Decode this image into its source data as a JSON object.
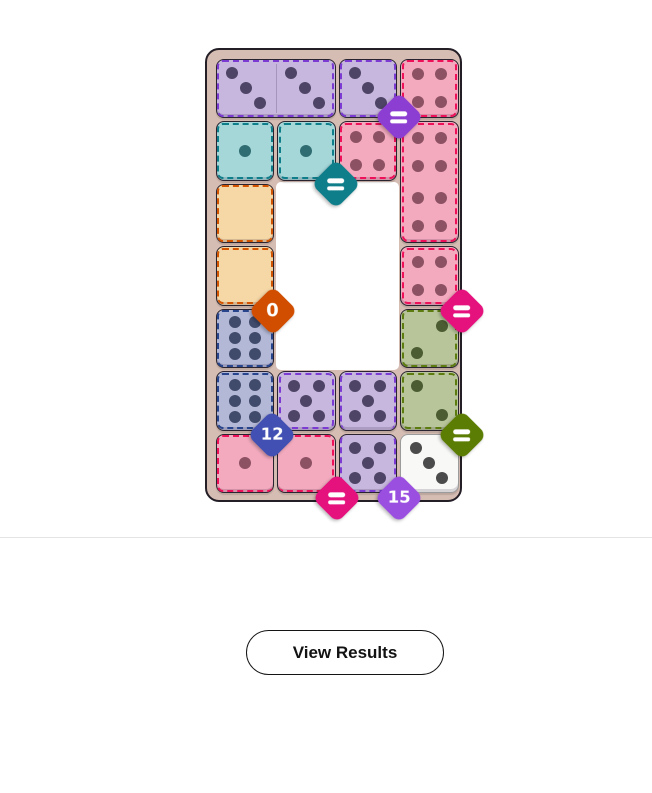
{
  "title": "Domino puzzle board (completed)",
  "board": {
    "x": 205,
    "y": 48,
    "width": 257,
    "height": 454,
    "frame_color": "#d6bdb3",
    "frame_border_color": "#241e26",
    "grid": {
      "x0": 7,
      "y0": 7,
      "cell_w": 61.5,
      "cell_h": 62.5,
      "cols": 4,
      "rows": 7
    },
    "hole": {
      "col": 1,
      "row": 2,
      "cols": 2,
      "rows": 3,
      "color": "#ffffff"
    },
    "regions": {
      "purple": {
        "bg": "#c7b7de",
        "dash": "#7b3ad2",
        "pip": "#4e4566"
      },
      "lavender": {
        "bg": "#c7b7de",
        "dash": "#7b3ad2",
        "pip": "#4e4566"
      },
      "red": {
        "bg": "#f3aabe",
        "dash": "#ee1059",
        "pip": "#8d5164"
      },
      "redb": {
        "bg": "#f3aabe",
        "dash": "#ee1059",
        "pip": "#8d5164"
      },
      "teal": {
        "bg": "#a5d7d9",
        "dash": "#0f7e8b",
        "pip": "#2f6d72"
      },
      "tan": {
        "bg": "#f6d8a7",
        "dash": "#d35400",
        "pip": "#7a5a20"
      },
      "blue": {
        "bg": "#b3b8d6",
        "dash": "#27448d",
        "pip": "#404a6b"
      },
      "green": {
        "bg": "#b8c59a",
        "dash": "#5c7c10",
        "pip": "#4c5c32"
      },
      "plain": {
        "bg": "#f8f8f6",
        "dash": null,
        "pip": "#4b4b4b",
        "border": "#9b9b9b"
      }
    },
    "pip_patterns": {
      "p0": [],
      "p1": [
        [
          50,
          50
        ]
      ],
      "p2dr": [
        [
          28,
          25
        ],
        [
          72,
          75
        ]
      ],
      "p2ur": [
        [
          72,
          29
        ],
        [
          28,
          75
        ]
      ],
      "p3": [
        [
          27,
          24
        ],
        [
          50,
          50
        ],
        [
          73,
          76
        ]
      ],
      "p4": [
        [
          30,
          26
        ],
        [
          70,
          26
        ],
        [
          30,
          74
        ],
        [
          70,
          74
        ]
      ],
      "p5": [
        [
          28,
          24
        ],
        [
          72,
          24
        ],
        [
          50,
          50
        ],
        [
          28,
          76
        ],
        [
          72,
          76
        ]
      ],
      "p6": [
        [
          32,
          22
        ],
        [
          68,
          22
        ],
        [
          32,
          50
        ],
        [
          68,
          50
        ],
        [
          32,
          78
        ],
        [
          68,
          78
        ]
      ]
    },
    "tiles": [
      {
        "name": "domino-3-3",
        "col": 0,
        "row": 0,
        "cols": 2,
        "rows": 1,
        "region": "purple",
        "faces": [
          "p3",
          "p3"
        ],
        "values": [
          3,
          3
        ],
        "seam": true
      },
      {
        "name": "half-3",
        "col": 2,
        "row": 0,
        "region": "purple",
        "faces": [
          "p3"
        ],
        "values": [
          3
        ]
      },
      {
        "name": "half-4",
        "col": 3,
        "row": 0,
        "region": "red",
        "faces": [
          "p4"
        ],
        "values": [
          4
        ]
      },
      {
        "name": "half-1",
        "col": 0,
        "row": 1,
        "region": "teal",
        "faces": [
          "p1"
        ],
        "values": [
          1
        ]
      },
      {
        "name": "half-1",
        "col": 1,
        "row": 1,
        "region": "teal",
        "faces": [
          "p1"
        ],
        "values": [
          1
        ]
      },
      {
        "name": "half-4",
        "col": 2,
        "row": 1,
        "region": "red",
        "faces": [
          "p4"
        ],
        "values": [
          4
        ]
      },
      {
        "name": "domino-4-4",
        "col": 3,
        "row": 1,
        "cols": 1,
        "rows": 2,
        "region": "red",
        "faces": [
          "p4",
          "p4"
        ],
        "values": [
          4,
          4
        ]
      },
      {
        "name": "half-0",
        "col": 0,
        "row": 2,
        "region": "tan",
        "faces": [
          "p0"
        ],
        "values": [
          0
        ]
      },
      {
        "name": "half-0",
        "col": 0,
        "row": 3,
        "region": "tan",
        "faces": [
          "p0"
        ],
        "values": [
          0
        ]
      },
      {
        "name": "half-4",
        "col": 3,
        "row": 3,
        "region": "red",
        "faces": [
          "p4"
        ],
        "values": [
          4
        ]
      },
      {
        "name": "half-6",
        "col": 0,
        "row": 4,
        "region": "blue",
        "faces": [
          "p6"
        ],
        "values": [
          6
        ]
      },
      {
        "name": "half-2",
        "col": 3,
        "row": 4,
        "region": "green",
        "faces": [
          "p2ur"
        ],
        "values": [
          2
        ]
      },
      {
        "name": "half-6",
        "col": 0,
        "row": 5,
        "region": "blue",
        "faces": [
          "p6"
        ],
        "values": [
          6
        ]
      },
      {
        "name": "half-5",
        "col": 1,
        "row": 5,
        "region": "lavender",
        "faces": [
          "p5"
        ],
        "values": [
          5
        ]
      },
      {
        "name": "half-5",
        "col": 2,
        "row": 5,
        "region": "lavender",
        "faces": [
          "p5"
        ],
        "values": [
          5
        ],
        "no_dash": [
          "bottom"
        ]
      },
      {
        "name": "half-2",
        "col": 3,
        "row": 5,
        "region": "green",
        "faces": [
          "p2dr"
        ],
        "values": [
          2
        ]
      },
      {
        "name": "half-1",
        "col": 0,
        "row": 6,
        "region": "redb",
        "faces": [
          "p1"
        ],
        "values": [
          1
        ],
        "no_dash": [
          "right"
        ]
      },
      {
        "name": "half-1",
        "col": 1,
        "row": 6,
        "region": "redb",
        "faces": [
          "p1"
        ],
        "values": [
          1
        ],
        "no_dash": [
          "left"
        ]
      },
      {
        "name": "half-5",
        "col": 2,
        "row": 6,
        "region": "lavender",
        "faces": [
          "p5"
        ],
        "values": [
          5
        ],
        "no_dash": [
          "top"
        ]
      },
      {
        "name": "half-3",
        "col": 3,
        "row": 6,
        "region": "plain",
        "faces": [
          "p3"
        ],
        "values": [
          3
        ]
      }
    ],
    "badges": [
      {
        "name": "constraint-badge-purple-equals",
        "col": 3,
        "row": 1,
        "dx": 0,
        "dy": -3,
        "color": "#8d3ed2",
        "kind": "equals",
        "label": "="
      },
      {
        "name": "constraint-badge-teal-equals",
        "col": 2,
        "row": 2,
        "dx": -1,
        "dy": 2,
        "color": "#0f7e8b",
        "kind": "equals",
        "label": "="
      },
      {
        "name": "constraint-badge-sum-0",
        "col": 1,
        "row": 4,
        "dx": -3,
        "dy": 4,
        "color": "#d14e00",
        "kind": "number",
        "label": "0"
      },
      {
        "name": "constraint-badge-magenta-equals-right",
        "col": 4,
        "row": 4,
        "dx": 2,
        "dy": 4,
        "color": "#e5117d",
        "kind": "equals",
        "label": "="
      },
      {
        "name": "constraint-badge-sum-12",
        "col": 1,
        "row": 6,
        "dx": -4,
        "dy": 3,
        "color": "#4150b2",
        "kind": "number",
        "label": "12"
      },
      {
        "name": "constraint-badge-green-equals",
        "col": 4,
        "row": 6,
        "dx": 2,
        "dy": 3,
        "color": "#5c7d04",
        "kind": "equals",
        "label": "="
      },
      {
        "name": "constraint-badge-magenta-equals-bottom",
        "col": 2,
        "row": 7,
        "dx": 0,
        "dy": 3,
        "color": "#e5117d",
        "kind": "equals",
        "label": "="
      },
      {
        "name": "constraint-badge-sum-15",
        "col": 3,
        "row": 7,
        "dx": 0,
        "dy": 3,
        "color": "#9b4fe0",
        "kind": "number",
        "label": "15"
      }
    ]
  },
  "divider": {
    "y": 537,
    "color": "#e4e4e4"
  },
  "button": {
    "label": "View Results",
    "x": 246,
    "y": 630,
    "width": 198,
    "height": 45,
    "bg": "#ffffff",
    "border_color": "#141414",
    "text_color": "#121212"
  }
}
